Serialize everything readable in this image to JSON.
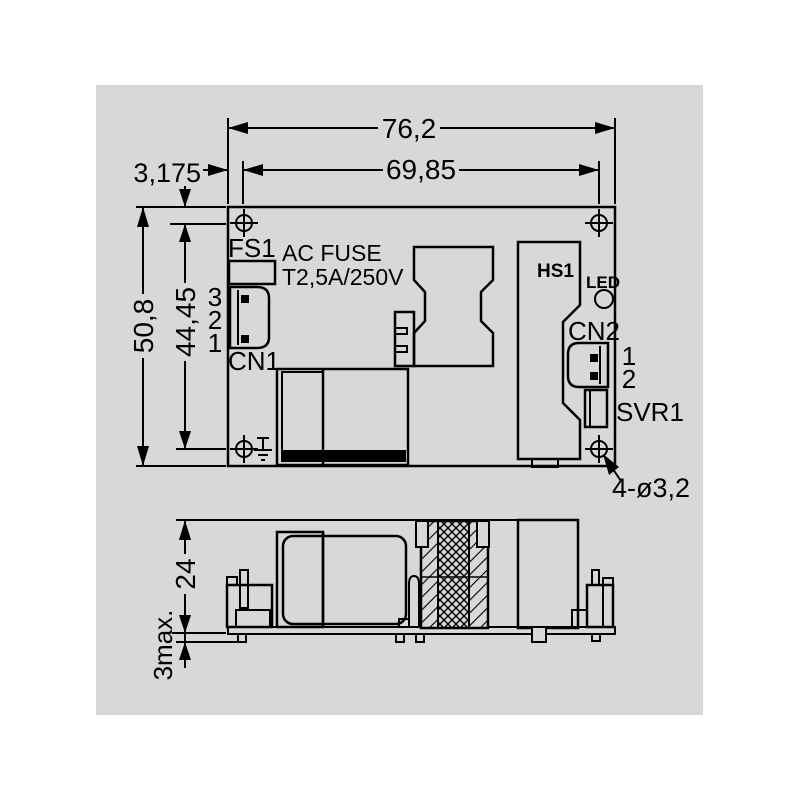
{
  "colors": {
    "background": "#ffffff",
    "canvas": "#d8d8d8",
    "line": "#000000"
  },
  "top_view": {
    "dim_width_overall": "76,2",
    "dim_width_holes": "69,85",
    "dim_hole_offset": "3,175",
    "dim_height_overall": "50,8",
    "dim_height_holes": "44,45",
    "hole_note": "4-ø3,2",
    "fuse_ref": "FS1",
    "fuse_note1": "AC FUSE",
    "fuse_note2": "T2,5A/250V",
    "cn1_ref": "CN1",
    "cn1_pins": [
      "3",
      "2",
      "1"
    ],
    "heatsink_ref": "HS1",
    "led_ref": "LED",
    "cn2_ref": "CN2",
    "cn2_pins": [
      "1",
      "2"
    ],
    "svr_ref": "SVR1"
  },
  "side_view": {
    "dim_component_height": "24",
    "dim_pin_protrusion": "3max."
  }
}
